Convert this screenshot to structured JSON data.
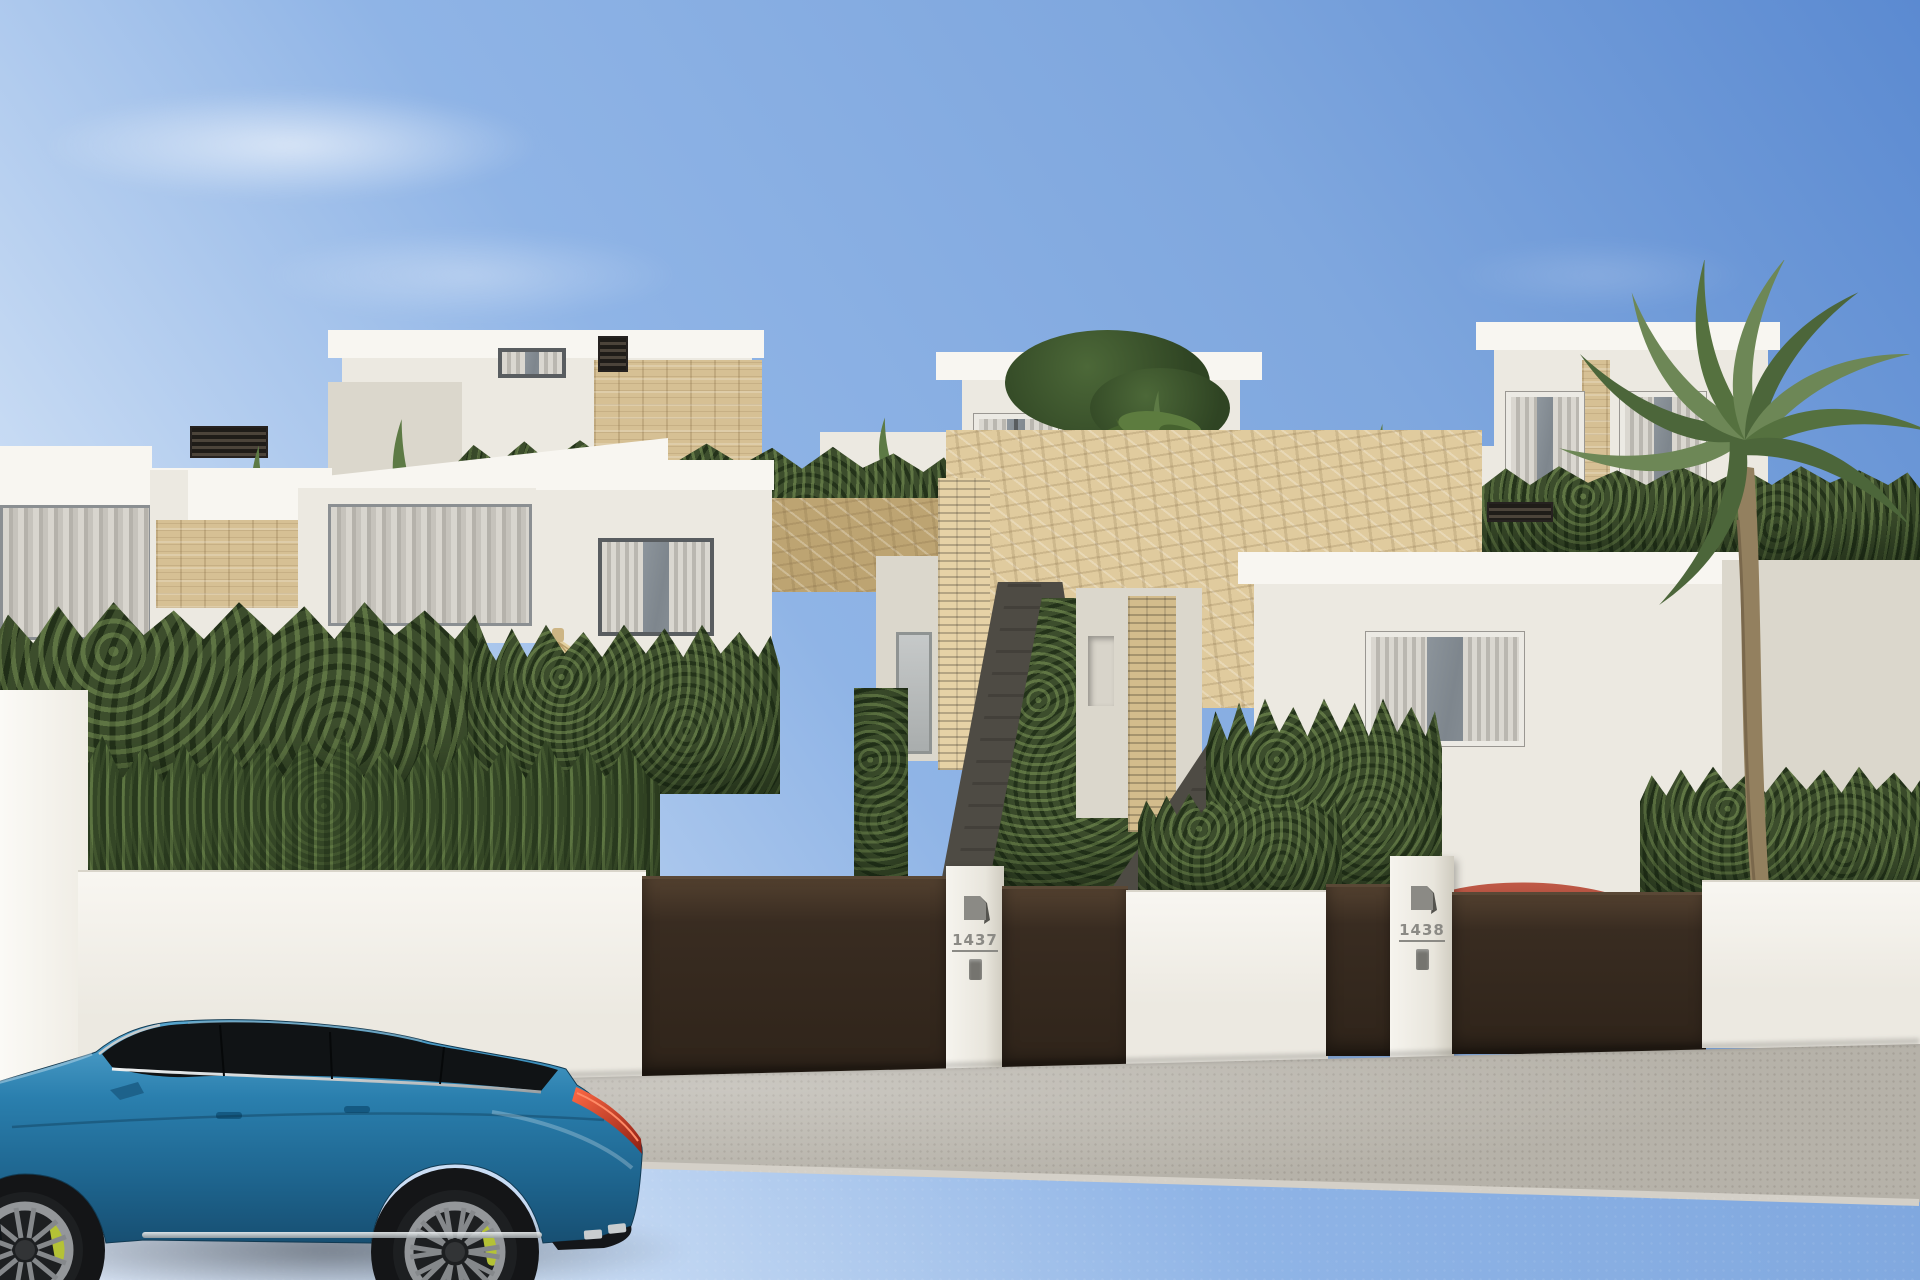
{
  "gates": [
    {
      "number": "1437",
      "logo_icon": "builder-logo-icon",
      "intercom_icon": "intercom-icon"
    },
    {
      "number": "1438",
      "logo_icon": "builder-logo-icon",
      "intercom_icon": "intercom-icon"
    }
  ],
  "icons": {
    "builder-logo": "folded-corner-square",
    "intercom": "small-rounded-panel"
  },
  "colors": {
    "sky-top": "#5b8ad1",
    "sky-mid": "#8fb4e6",
    "sky-low": "#c9dcf4",
    "white-lit": "#f8f6f1",
    "white-base": "#ece9e1",
    "white-shade": "#dbd7cc",
    "stone": "#d6c094",
    "stone-dark": "#bda472",
    "hedge": "#3c4d2c",
    "hedge-light": "#6d8752",
    "gate": "#392c21",
    "gate-light": "#52402f",
    "sidewalk": "#b6b2a9",
    "road": "#8f8f8d",
    "path-light": "#cfcdc8",
    "plaque": "#8b8a85",
    "car-blue": "#2a7fae",
    "car-roof": "#101315",
    "tail-red": "#d84a33",
    "caliper-green": "#b4c236",
    "red-car": "#a84538",
    "straw": "#d9c38e",
    "palm-green": "#5d7a45",
    "trunk": "#93805f"
  }
}
